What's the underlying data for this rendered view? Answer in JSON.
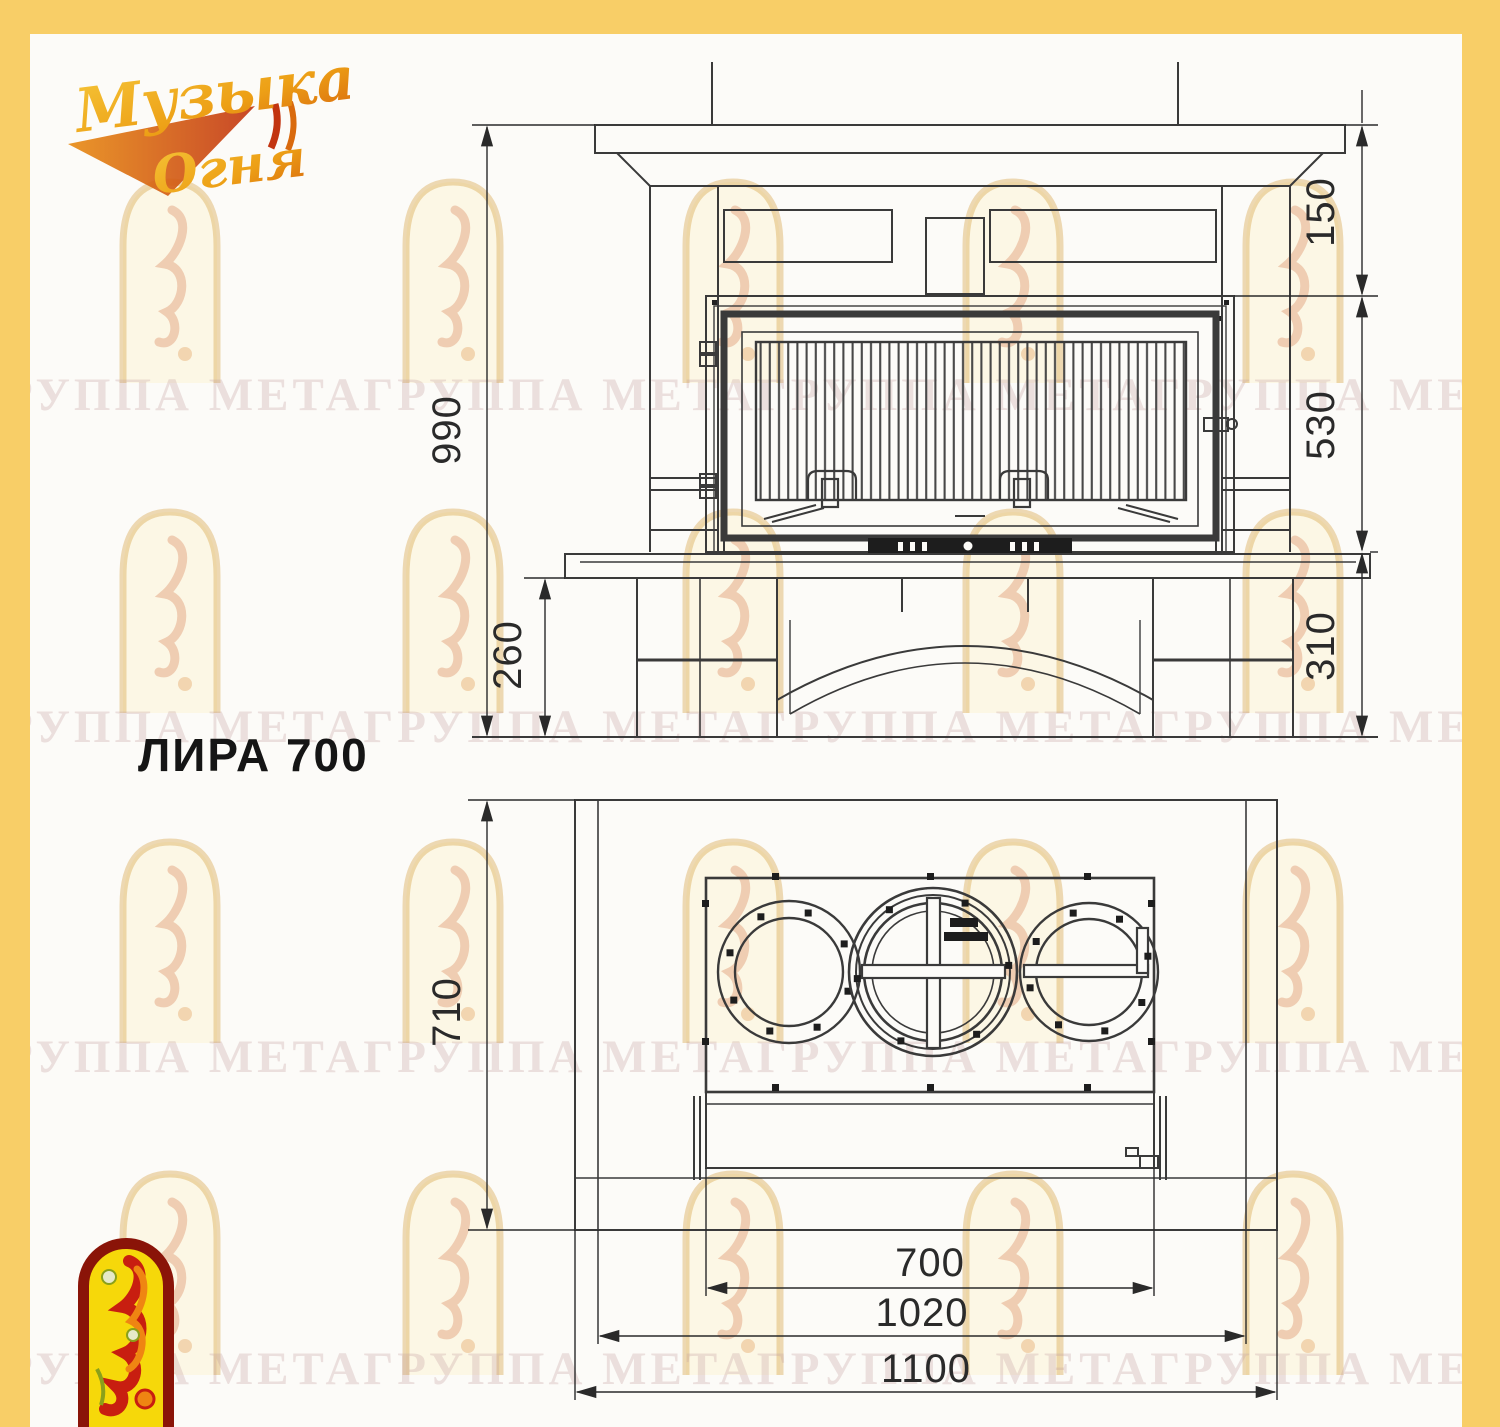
{
  "title": "ЛИРА 700",
  "logo": {
    "line1": "Музыка",
    "line2": "Огня"
  },
  "watermark": {
    "row_text": "ГРУППА МЕТАГРУППА МЕТАГРУППА МЕТАГРУППА МЕТА ГРУППА МЕТА"
  },
  "front_view": {
    "dims": {
      "total_height": "990",
      "mantel_to_firebox_top": "150",
      "firebox_height": "530",
      "hearth_to_floor": "310",
      "plinth_height": "260"
    }
  },
  "plan_view": {
    "dims": {
      "depth": "710",
      "insert_width": "700",
      "inner_width": "1020",
      "total_width": "1100"
    }
  },
  "colors": {
    "border_yellow": "#f8ce67",
    "line_dark": "#3a3a3a",
    "emblem_red": "#8a1408",
    "emblem_yellow": "#f6d80a",
    "logo_gold": "#f2b21c",
    "logo_red": "#c23410"
  }
}
